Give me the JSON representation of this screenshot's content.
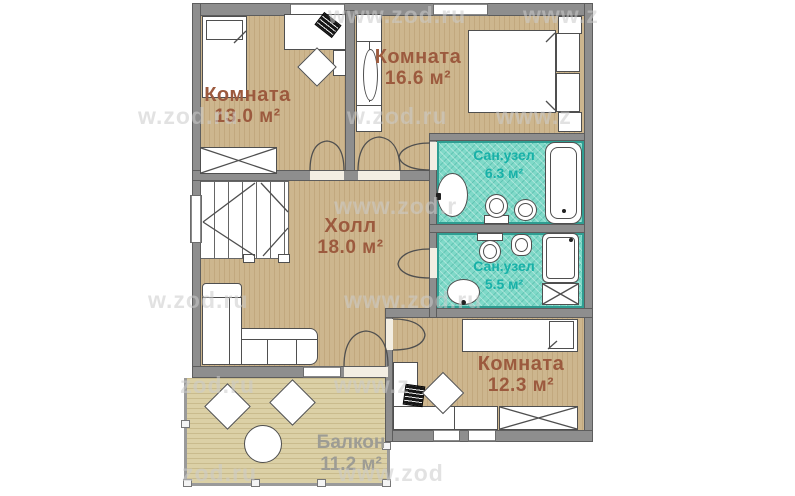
{
  "labels": {
    "room13": {
      "name": "Комната",
      "area": "13.0 м²"
    },
    "room16": {
      "name": "Комната",
      "area": "16.6 м²"
    },
    "bath63": {
      "name": "Сан.узел",
      "area": "6.3 м²"
    },
    "bath55": {
      "name": "Сан.узел",
      "area": "5.5 м²"
    },
    "hall": {
      "name": "Холл",
      "area": "18.0 м²"
    },
    "room12": {
      "name": "Комната",
      "area": "12.3 м²"
    },
    "balcony": {
      "name": "Балкон",
      "area": "11.2 м²"
    }
  },
  "colors": {
    "wall": "#8e8e8e",
    "wood_floor": "#cdb68e",
    "balcony_floor": "#dbd0a6",
    "bath_floor": "#7fd9c8",
    "room_label": "#9c5a3e",
    "bath_label": "#17b1a8",
    "balcony_label": "#9d9c94"
  },
  "watermarks": [
    {
      "text": "www.zod.ru"
    },
    {
      "text": "www.z"
    },
    {
      "text": "w.zod.ru"
    },
    {
      "text": "w.zod.ru"
    },
    {
      "text": "www.z"
    },
    {
      "text": "www.zod.r"
    },
    {
      "text": "w.zod.ru"
    },
    {
      "text": "www.zod.ru"
    },
    {
      "text": "zod.ru"
    },
    {
      "text": "www.z"
    },
    {
      "text": "zod.ru"
    },
    {
      "text": "www.zod"
    }
  ]
}
